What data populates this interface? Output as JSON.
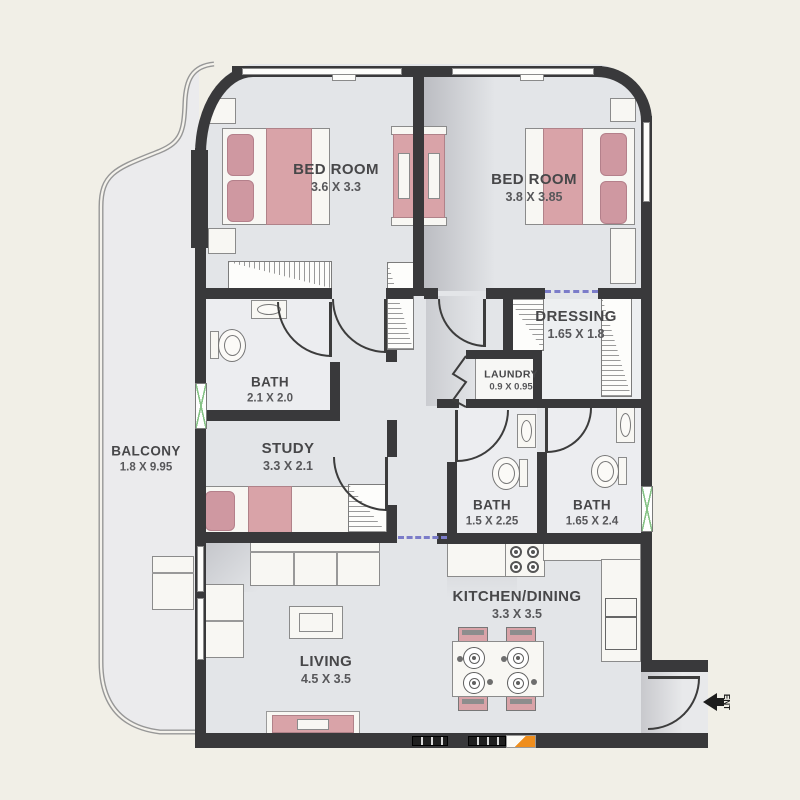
{
  "title": "apartment-floor-plan",
  "palette": {
    "background": "#f1efe7",
    "floor": "#e3e5e8",
    "wall": "#39393b",
    "furniture_pink": "#d9a3a8",
    "window_green": "#85c285",
    "opening_dash_blue": "#7b7cc9",
    "marker_orange": "#ef8e1d"
  },
  "rooms": {
    "bedroom_left": {
      "name": "BED ROOM",
      "dims": "3.6 X 3.3"
    },
    "bedroom_right": {
      "name": "BED ROOM",
      "dims": "3.8 X 3.85"
    },
    "dressing": {
      "name": "DRESSING",
      "dims": "1.65 X 1.8"
    },
    "laundry": {
      "name": "LAUNDRY",
      "dims": "0.9 X 0.95"
    },
    "bath_top": {
      "name": "BATH",
      "dims": "2.1 X 2.0"
    },
    "study": {
      "name": "STUDY",
      "dims": "3.3 X 2.1"
    },
    "balcony": {
      "name": "BALCONY",
      "dims": "1.8 X 9.95"
    },
    "bath_mid": {
      "name": "BATH",
      "dims": "1.5 X 2.25"
    },
    "bath_right": {
      "name": "BATH",
      "dims": "1.65 X 2.4"
    },
    "kitchen_dining": {
      "name": "KITCHEN/DINING",
      "dims": "3.3 X 3.5"
    },
    "living": {
      "name": "LIVING",
      "dims": "4.5 X 3.5"
    }
  },
  "entrance": {
    "label": "ENT"
  }
}
